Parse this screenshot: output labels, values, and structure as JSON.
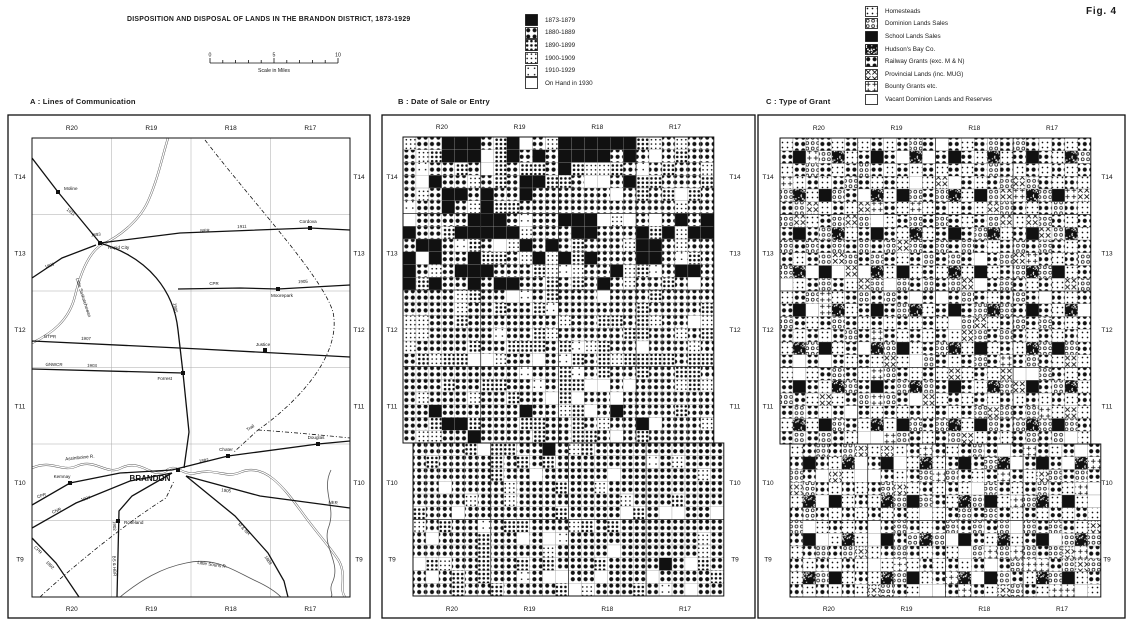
{
  "fig_label": "Fig. 4",
  "title": "DISPOSITION AND DISPOSAL OF LANDS IN THE BRANDON DISTRICT, 1873-1929",
  "scale_bar": {
    "tick_labels": [
      "0",
      "5",
      "10"
    ],
    "caption": "Scale in Miles"
  },
  "ranges": [
    "R20",
    "R19",
    "R18",
    "R17"
  ],
  "townships": [
    "T14",
    "T13",
    "T12",
    "T11",
    "T10",
    "T9"
  ],
  "colors": {
    "ink": "#111111",
    "paper": "#ffffff",
    "grid": "#aaaaaa",
    "river": "#555555"
  },
  "date_legend": {
    "items": [
      {
        "label": "1873-1879",
        "pattern": "d1873"
      },
      {
        "label": "1880-1889",
        "pattern": "d1880"
      },
      {
        "label": "1890-1899",
        "pattern": "d1890"
      },
      {
        "label": "1900-1909",
        "pattern": "d1900"
      },
      {
        "label": "1910-1929",
        "pattern": "d1910"
      },
      {
        "label": "On Hand in 1930",
        "pattern": "d1930"
      }
    ]
  },
  "type_legend": {
    "items": [
      {
        "label": "Homesteads",
        "pattern": "homesteads"
      },
      {
        "label": "Dominion Lands Sales",
        "pattern": "dominion"
      },
      {
        "label": "School Lands Sales",
        "pattern": "school"
      },
      {
        "label": "Hudson's Bay Co.",
        "pattern": "hbc"
      },
      {
        "label": "Railway Grants (exc. M & N)",
        "pattern": "railway"
      },
      {
        "label": "Provincial Lands (inc. MUG)",
        "pattern": "provincial"
      },
      {
        "label": "Bounty Grants etc.",
        "pattern": "bounty"
      },
      {
        "label": "Vacant Dominion Lands and Reserves",
        "pattern": "vacant"
      }
    ]
  },
  "panel_a": {
    "title": "A : Lines of Communication",
    "towns": [
      {
        "name": "Moline",
        "x": 58,
        "y": 192,
        "lx": 64,
        "ly": 190,
        "anchor": "start"
      },
      {
        "name": "Rapid City",
        "x": 100,
        "y": 243,
        "lx": 108,
        "ly": 249,
        "anchor": "start"
      },
      {
        "name": "Cordova",
        "x": 310,
        "y": 228,
        "lx": 308,
        "ly": 223,
        "anchor": "middle"
      },
      {
        "name": "Moorepark",
        "x": 278,
        "y": 289,
        "lx": 282,
        "ly": 297,
        "anchor": "middle"
      },
      {
        "name": "Justice",
        "x": 265,
        "y": 350,
        "lx": 263,
        "ly": 346,
        "anchor": "middle"
      },
      {
        "name": "Forrest",
        "x": 183,
        "y": 373,
        "lx": 172,
        "ly": 380,
        "anchor": "end"
      },
      {
        "name": "Chater",
        "x": 228,
        "y": 456,
        "lx": 226,
        "ly": 451,
        "anchor": "middle"
      },
      {
        "name": "Douglas",
        "x": 318,
        "y": 444,
        "lx": 316,
        "ly": 439,
        "anchor": "middle"
      },
      {
        "name": "Kemnay",
        "x": 70,
        "y": 483,
        "lx": 62,
        "ly": 478,
        "anchor": "middle"
      },
      {
        "name": "Roseland",
        "x": 118,
        "y": 521,
        "lx": 124,
        "ly": 524,
        "anchor": "start"
      },
      {
        "name": "BRANDON",
        "x": 178,
        "y": 470,
        "lx": 150,
        "ly": 481,
        "anchor": "middle",
        "major": true
      }
    ],
    "railways": [
      {
        "id": "cpr-west",
        "path": "M 32 505 L 70 483 L 120 473 L 172 470",
        "labels": [
          {
            "t": "CPR",
            "x": 42,
            "y": 497,
            "r": -18
          }
        ]
      },
      {
        "id": "cpr-east",
        "path": "M 172 470 L 228 456 L 318 444 L 350 441",
        "labels": [
          {
            "t": "1882",
            "x": 204,
            "y": 462,
            "r": -8
          }
        ]
      },
      {
        "id": "line-1911-nw",
        "path": "M 32 158 L 58 192 L 100 243",
        "labels": [
          {
            "t": "1911",
            "x": 70,
            "y": 213,
            "r": 38
          }
        ]
      },
      {
        "id": "line-1890",
        "path": "M 32 278 L 62 258 L 96 245",
        "labels": [
          {
            "t": "1890",
            "x": 50,
            "y": 267,
            "r": -20
          },
          {
            "t": "1893",
            "x": 96,
            "y": 236,
            "r": -5
          }
        ]
      },
      {
        "id": "ner-1911",
        "path": "M 100 243 L 180 233 L 310 228 L 350 230",
        "labels": [
          {
            "t": "NER",
            "x": 205,
            "y": 232,
            "r": -2
          },
          {
            "t": "1911",
            "x": 242,
            "y": 228,
            "r": -2
          }
        ]
      },
      {
        "id": "cpr-moorepark",
        "path": "M 178 289 L 240 288 L 278 289 L 350 285",
        "labels": [
          {
            "t": "CPR",
            "x": 214,
            "y": 285,
            "r": 0
          },
          {
            "t": "1905",
            "x": 303,
            "y": 283,
            "r": -2
          }
        ]
      },
      {
        "id": "gtpr",
        "path": "M 32 341 L 200 349 L 350 357",
        "labels": [
          {
            "t": "GTPR",
            "x": 50,
            "y": 338,
            "r": 2
          },
          {
            "t": "1907",
            "x": 86,
            "y": 340,
            "r": 2
          }
        ]
      },
      {
        "id": "gnwcr",
        "path": "M 32 369 L 183 373",
        "labels": [
          {
            "t": "GNWCR",
            "x": 54,
            "y": 366,
            "r": 1
          },
          {
            "t": "1903",
            "x": 92,
            "y": 367,
            "r": 1
          }
        ]
      },
      {
        "id": "ns-line",
        "path": "M 100 243 C 150 258 174 292 178 330 L 183 373 L 189 432 L 184 468",
        "labels": [
          {
            "t": "1905",
            "x": 174,
            "y": 308,
            "r": 83
          }
        ]
      },
      {
        "id": "mnr-se",
        "path": "M 186 476 L 235 516 L 268 553 L 284 581 L 288 597",
        "labels": [
          {
            "t": "M & NR",
            "x": 243,
            "y": 530,
            "r": 46
          },
          {
            "t": "1889",
            "x": 267,
            "y": 561,
            "r": 55
          }
        ]
      },
      {
        "id": "cpr-sw",
        "path": "M 32 538 L 56 563 L 79 597",
        "labels": [
          {
            "t": "CPR",
            "x": 37,
            "y": 551,
            "r": 46
          },
          {
            "t": "1892",
            "x": 49,
            "y": 566,
            "r": 46
          }
        ]
      },
      {
        "id": "bshbr",
        "path": "M 172 473 L 132 496 L 119 511 L 117 597",
        "labels": [
          {
            "t": "1902",
            "x": 113,
            "y": 526,
            "r": 87
          },
          {
            "t": "BS & HBR",
            "x": 113,
            "y": 566,
            "r": 87
          }
        ]
      },
      {
        "id": "ner-se",
        "path": "M 186 476 L 260 496 L 350 508",
        "labels": [
          {
            "t": "1905",
            "x": 226,
            "y": 492,
            "r": 7
          },
          {
            "t": "NER",
            "x": 333,
            "y": 504,
            "r": 5
          }
        ]
      },
      {
        "id": "cnr-west",
        "path": "M 32 528 L 76 503 L 130 481 L 172 473",
        "labels": [
          {
            "t": "CNR",
            "x": 57,
            "y": 512,
            "r": -22
          },
          {
            "t": "1907",
            "x": 86,
            "y": 500,
            "r": -17
          }
        ]
      }
    ],
    "trails": [
      {
        "id": "trail-ne",
        "path": "M 205 140 C 255 205 322 276 333 312 C 342 355 298 402 258 430 L 234 452",
        "label": {
          "t": "Trail",
          "x": 251,
          "y": 429,
          "r": -32
        }
      },
      {
        "id": "trail-east",
        "path": "M 258 430 C 290 432 330 436 350 438"
      },
      {
        "id": "trail-sw",
        "path": "M 40 597 C 80 560 132 519 166 498 L 174 481"
      }
    ],
    "rivers": [
      {
        "id": "little-saskatchewan",
        "double": true,
        "path": "M 168 138 C 162 158 158 178 149 199 C 141 219 121 236 101 245 C 89 253 81 271 75 296 C 69 321 51 334 32 343",
        "label": {
          "t": "Little Saskatchewan",
          "x": 82,
          "y": 298,
          "r": 72
        }
      },
      {
        "id": "assiniboine",
        "double": true,
        "path": "M 32 468 C 52 459 62 473 77 466 C 96 458 106 476 121 468 C 141 458 151 479 166 471 C 176 462 181 476 196 473 C 216 468 226 479 241 472 C 266 462 286 491 301 511 C 316 532 331 548 339 561 C 347 576 339 590 345 597",
        "label": {
          "t": "Assiniboine R.",
          "x": 80,
          "y": 459,
          "r": -6
        }
      },
      {
        "id": "little-souris",
        "double": false,
        "path": "M 120 597 C 141 580 161 568 186 563 C 216 556 236 572 256 581 C 269 587 276 592 281 597",
        "label": {
          "t": "Little Souris R.",
          "x": 212,
          "y": 566,
          "r": 8
        }
      },
      {
        "id": "se-creek",
        "double": false,
        "path": "M 331 470 C 321 490 336 506 329 526 C 321 546 341 561 333 581 C 328 591 334 594 331 597"
      }
    ]
  },
  "panel_b": {
    "title": "B : Date of Sale or Entry",
    "bands": [
      {
        "township": "T14",
        "rows": [
          0,
          5
        ],
        "weights": {
          "d1873": 0.32,
          "d1880": 0.36,
          "d1890": 0.15,
          "d1900": 0.09,
          "d1910": 0.03,
          "d1930": 0.05
        }
      },
      {
        "township": "T13",
        "rows": [
          6,
          11
        ],
        "weights": {
          "d1873": 0.34,
          "d1880": 0.36,
          "d1890": 0.14,
          "d1900": 0.08,
          "d1910": 0.03,
          "d1930": 0.05
        }
      },
      {
        "township": "T12",
        "rows": [
          12,
          17
        ],
        "weights": {
          "d1873": 0.1,
          "d1880": 0.5,
          "d1890": 0.2,
          "d1900": 0.11,
          "d1910": 0.04,
          "d1930": 0.05
        }
      },
      {
        "township": "T11",
        "rows": [
          18,
          23
        ],
        "weights": {
          "d1873": 0.16,
          "d1880": 0.5,
          "d1890": 0.16,
          "d1900": 0.09,
          "d1910": 0.04,
          "d1930": 0.05
        }
      },
      {
        "township": "T10-T9",
        "rows": [
          24,
          35
        ],
        "weights": {
          "d1873": 0.015,
          "d1880": 0.7,
          "d1890": 0.14,
          "d1900": 0.06,
          "d1910": 0.015,
          "d1930": 0.07
        }
      }
    ]
  },
  "panel_c": {
    "title": "C : Type of Grant",
    "fixed": {
      "school": [
        [
          1,
          1
        ],
        [
          4,
          3
        ]
      ],
      "hbc": [
        [
          4,
          1
        ],
        [
          1,
          4
        ]
      ]
    },
    "mix": {
      "odd_sections": {
        "railway": 0.78,
        "provincial": 0.1,
        "vacant": 0.07,
        "bounty": 0.05
      },
      "even_sections": {
        "homesteads": 0.52,
        "dominion": 0.34,
        "bounty": 0.05,
        "vacant": 0.09
      }
    }
  }
}
